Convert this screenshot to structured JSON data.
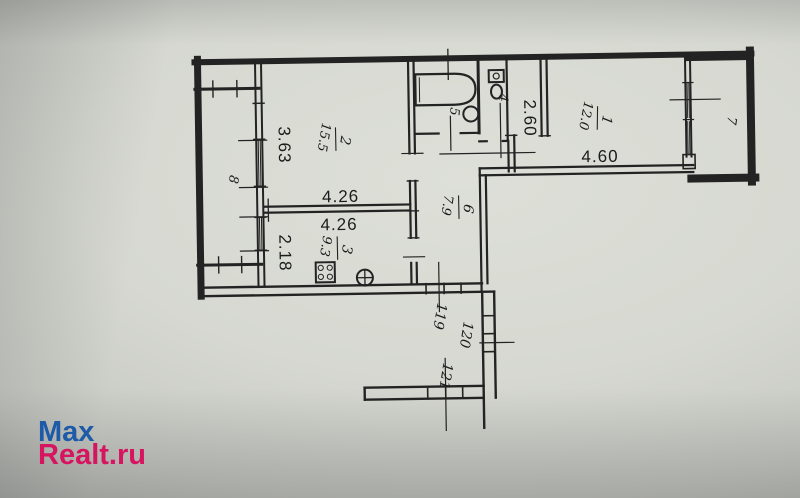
{
  "watermark": {
    "line1": "Max",
    "line2": "Realt.ru",
    "color_top": "#1d5aa8",
    "color_bottom": "#d6145f"
  },
  "plan": {
    "rooms": {
      "room1": {
        "number": "1",
        "area": "12.0"
      },
      "room2": {
        "number": "2",
        "area": "15.5"
      },
      "room3": {
        "number": "3",
        "area": "9.3"
      },
      "room4": {
        "number": "4"
      },
      "room5": {
        "number": "5"
      },
      "room6": {
        "number": "6",
        "area": "7.9"
      },
      "room7": {
        "number": "7"
      },
      "room8": {
        "number": "8"
      }
    },
    "dimensions": {
      "d363": "3.63",
      "d426a": "4.26",
      "d426b": "4.26",
      "d218": "2.18",
      "d260": "2.60",
      "d460": "4.60"
    },
    "units": {
      "u119": "119",
      "u120": "120",
      "u121": "121"
    },
    "colors": {
      "line": "#232323",
      "paper": "#d6d8d1"
    }
  }
}
